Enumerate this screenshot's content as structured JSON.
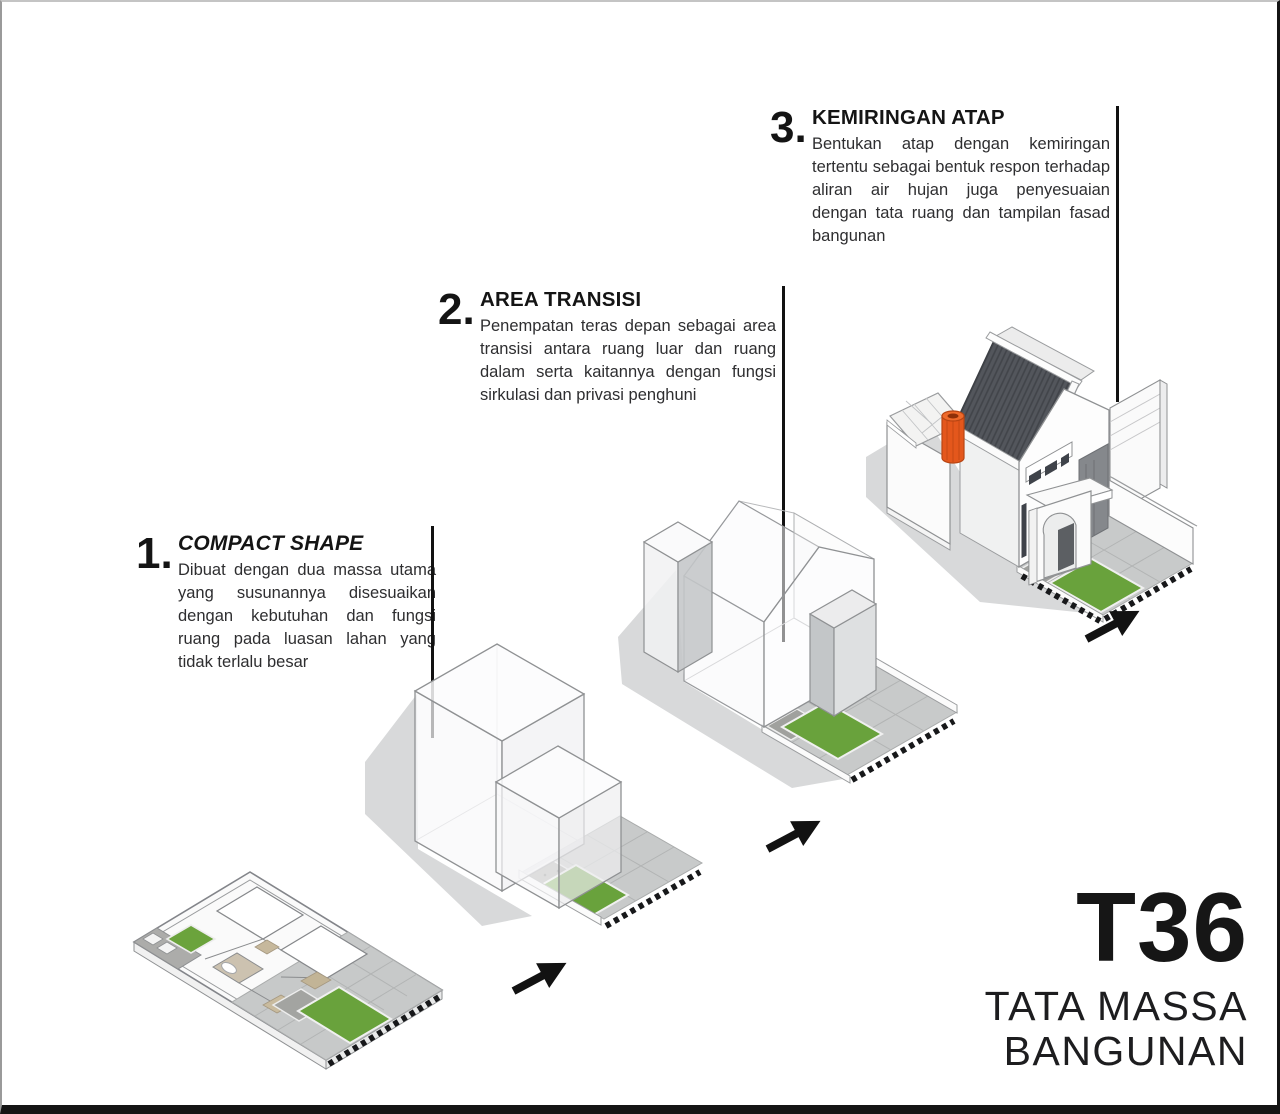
{
  "title_block": {
    "code": "T36",
    "subtitle": [
      "TATA MASSA",
      "BANGUNAN"
    ]
  },
  "sections": [
    {
      "number": "1.",
      "title": "COMPACT SHAPE",
      "body": "Dibuat dengan dua massa utama yang susunannya disesuaikan dengan kebutuhan dan fungsi ruang pada luasan lahan yang tidak terlalu besar"
    },
    {
      "number": "2.",
      "title": "AREA TRANSISI",
      "body": "Penempatan teras depan sebagai area transisi antara ruang luar dan ruang dalam serta kaitannya dengan fungsi sirkulasi dan privasi penghuni"
    },
    {
      "number": "3.",
      "title": "KEMIRINGAN ATAP",
      "body": "Bentukan atap dengan kemiringan tertentu sebagai bentuk respon terhadap aliran air hujan juga penyesuaian dengan tata ruang dan tampilan fasad bangunan"
    }
  ],
  "models": [
    {
      "name": "site-plan-isometric"
    },
    {
      "name": "massing-two-boxes"
    },
    {
      "name": "massing-transition-area"
    },
    {
      "name": "final-house-with-roof"
    }
  ],
  "colors": {
    "ink": "#141414",
    "grass": "#69a23c",
    "paving": "#c8caca",
    "gravel": "#a0a19e",
    "roof_dark": "#53565c",
    "tank_orange": "#e4571c",
    "shadow": "#d8d9da"
  }
}
